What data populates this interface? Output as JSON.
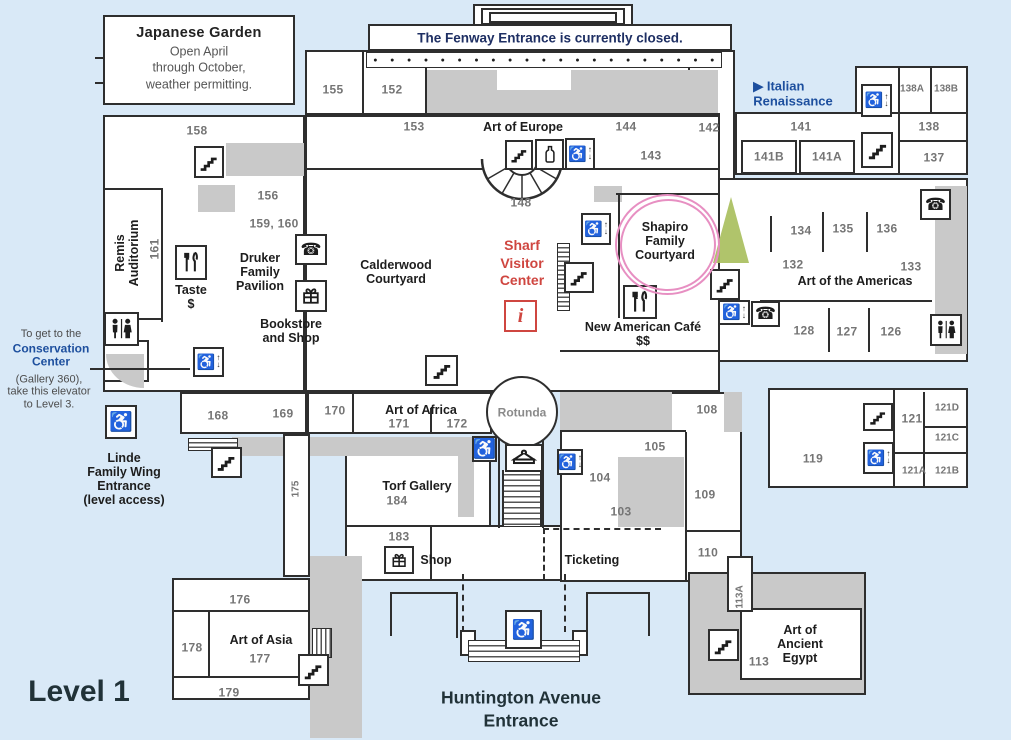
{
  "title": "Museum floor plan — Level 1",
  "level_label": "Level 1",
  "banner": {
    "text": "The Fenway Entrance is currently closed."
  },
  "entrances": {
    "huntington": "Huntington Avenue\nEntrance",
    "linde": "Linde\nFamily Wing\nEntrance\n(level access)",
    "fenway_closed": "The Fenway Entrance is currently closed."
  },
  "colors": {
    "background": "#d9e9f7",
    "wall": "#2e2e2e",
    "room_fill": "#ffffff",
    "service_fill": "#c9c9c9",
    "number_text": "#757575",
    "label_text": "#1d1d1d",
    "accent_red": "#cf4640",
    "accent_blue": "#1d4f9e",
    "banner_text": "#1e2f63",
    "highlight_pink": "#e78fc2",
    "marker_green": "#a9bf5e"
  },
  "labels": [
    {
      "t": "Japanese Garden",
      "x": 199,
      "y": 33,
      "c": "jgt",
      "n": "japanese-garden-title"
    },
    {
      "t": "Open April\nthrough October,\nweather permitting.",
      "x": 199,
      "y": 68,
      "c": "jgb",
      "n": "japanese-garden-note"
    },
    {
      "t": "The Fenway Entrance is currently closed.",
      "x": 550,
      "y": 38,
      "c": "banner-t",
      "n": "fenway-banner-text"
    },
    {
      "t": "155",
      "x": 333,
      "y": 90,
      "c": "num"
    },
    {
      "t": "152",
      "x": 392,
      "y": 90,
      "c": "num"
    },
    {
      "t": "158",
      "x": 197,
      "y": 131,
      "c": "num"
    },
    {
      "t": "153",
      "x": 414,
      "y": 127,
      "c": "num"
    },
    {
      "t": "Art of Europe",
      "x": 523,
      "y": 127,
      "c": "sec",
      "n": "art-of-europe-label"
    },
    {
      "t": "144",
      "x": 626,
      "y": 127,
      "c": "num"
    },
    {
      "t": "142",
      "x": 709,
      "y": 128,
      "c": "num"
    },
    {
      "t": "143",
      "x": 651,
      "y": 156,
      "c": "num"
    },
    {
      "t": "148",
      "x": 521,
      "y": 203,
      "c": "num"
    },
    {
      "t": "▶ Italian\nRenaissance",
      "x": 793,
      "y": 94,
      "c": "blue-t",
      "n": "italian-renaissance-label"
    },
    {
      "t": "141",
      "x": 801,
      "y": 127,
      "c": "num"
    },
    {
      "t": "141B",
      "x": 769,
      "y": 157,
      "c": "num"
    },
    {
      "t": "141A",
      "x": 827,
      "y": 157,
      "c": "num"
    },
    {
      "t": "138A",
      "x": 912,
      "y": 89,
      "c": "numS"
    },
    {
      "t": "138B",
      "x": 946,
      "y": 89,
      "c": "numS"
    },
    {
      "t": "138",
      "x": 929,
      "y": 127,
      "c": "num"
    },
    {
      "t": "137",
      "x": 934,
      "y": 158,
      "c": "num"
    },
    {
      "t": "156",
      "x": 268,
      "y": 196,
      "c": "num"
    },
    {
      "t": "159, 160",
      "x": 274,
      "y": 224,
      "c": "num"
    },
    {
      "t": "161",
      "x": 155,
      "y": 249,
      "c": "num vert"
    },
    {
      "t": "Remis\nAuditorium",
      "x": 127,
      "y": 253,
      "c": "sec vert",
      "n": "remis-auditorium-label"
    },
    {
      "t": "Druker\nFamily\nPavilion",
      "x": 260,
      "y": 272,
      "c": "sec",
      "n": "druker-family-pavilion-label"
    },
    {
      "t": "Taste\n$",
      "x": 191,
      "y": 297,
      "c": "sec",
      "n": "taste-label"
    },
    {
      "t": "Bookstore\nand Shop",
      "x": 291,
      "y": 331,
      "c": "sec",
      "n": "bookstore-and-shop-label"
    },
    {
      "t": "Calderwood\nCourtyard",
      "x": 396,
      "y": 272,
      "c": "sec",
      "n": "calderwood-courtyard-label"
    },
    {
      "t": "Sharf\nVisitor\nCenter",
      "x": 522,
      "y": 263,
      "c": "red-t",
      "n": "sharf-visitor-center-label"
    },
    {
      "t": "Shapiro\nFamily\nCourtyard",
      "x": 665,
      "y": 241,
      "c": "sec",
      "n": "shapiro-family-courtyard-label"
    },
    {
      "t": "New American Café\n$$",
      "x": 643,
      "y": 334,
      "c": "sec",
      "n": "new-american-cafe-label"
    },
    {
      "t": "134",
      "x": 801,
      "y": 231,
      "c": "num"
    },
    {
      "t": "135",
      "x": 843,
      "y": 229,
      "c": "num"
    },
    {
      "t": "136",
      "x": 887,
      "y": 229,
      "c": "num"
    },
    {
      "t": "132",
      "x": 793,
      "y": 265,
      "c": "num"
    },
    {
      "t": "133",
      "x": 911,
      "y": 267,
      "c": "num"
    },
    {
      "t": "Art of the Americas",
      "x": 855,
      "y": 281,
      "c": "sec",
      "n": "art-of-the-americas-label"
    },
    {
      "t": "128",
      "x": 804,
      "y": 331,
      "c": "num"
    },
    {
      "t": "127",
      "x": 847,
      "y": 332,
      "c": "num"
    },
    {
      "t": "126",
      "x": 891,
      "y": 332,
      "c": "num"
    },
    {
      "t": "To get to the",
      "x": 51,
      "y": 334,
      "c": "note",
      "n": "conservation-note-line1"
    },
    {
      "t": "Conservation\nCenter",
      "x": 51,
      "y": 356,
      "c": "noteB",
      "n": "conservation-center-label"
    },
    {
      "t": "(Gallery 360),\ntake this elevator\nto Level 3.",
      "x": 49,
      "y": 392,
      "c": "note",
      "n": "conservation-note-line2"
    },
    {
      "t": "Linde\nFamily Wing\nEntrance\n(level access)",
      "x": 124,
      "y": 479,
      "c": "sec",
      "n": "linde-family-wing-entrance-label"
    },
    {
      "t": "168",
      "x": 218,
      "y": 416,
      "c": "num"
    },
    {
      "t": "169",
      "x": 283,
      "y": 414,
      "c": "num"
    },
    {
      "t": "170",
      "x": 335,
      "y": 411,
      "c": "num"
    },
    {
      "t": "Art of Africa",
      "x": 421,
      "y": 410,
      "c": "sec",
      "n": "art-of-africa-label"
    },
    {
      "t": "171",
      "x": 399,
      "y": 424,
      "c": "num"
    },
    {
      "t": "172",
      "x": 457,
      "y": 424,
      "c": "num"
    },
    {
      "t": "Rotunda",
      "x": 522,
      "y": 413,
      "c": "gray-t",
      "n": "rotunda-label"
    },
    {
      "t": "175",
      "x": 296,
      "y": 489,
      "c": "numS vert"
    },
    {
      "t": "Torf Gallery",
      "x": 417,
      "y": 486,
      "c": "sec",
      "n": "torf-gallery-label"
    },
    {
      "t": "184",
      "x": 397,
      "y": 501,
      "c": "num"
    },
    {
      "t": "183",
      "x": 399,
      "y": 537,
      "c": "num"
    },
    {
      "t": "Shop",
      "x": 436,
      "y": 560,
      "c": "sec",
      "n": "shop-label"
    },
    {
      "t": "Ticketing",
      "x": 592,
      "y": 560,
      "c": "sec",
      "n": "ticketing-label"
    },
    {
      "t": "108",
      "x": 707,
      "y": 410,
      "c": "num"
    },
    {
      "t": "105",
      "x": 655,
      "y": 447,
      "c": "num"
    },
    {
      "t": "104",
      "x": 600,
      "y": 478,
      "c": "num"
    },
    {
      "t": "103",
      "x": 621,
      "y": 512,
      "c": "num"
    },
    {
      "t": "109",
      "x": 705,
      "y": 495,
      "c": "num"
    },
    {
      "t": "110",
      "x": 708,
      "y": 553,
      "c": "num"
    },
    {
      "t": "119",
      "x": 813,
      "y": 459,
      "c": "num"
    },
    {
      "t": "121",
      "x": 912,
      "y": 419,
      "c": "num"
    },
    {
      "t": "121D",
      "x": 947,
      "y": 408,
      "c": "numS"
    },
    {
      "t": "121C",
      "x": 947,
      "y": 438,
      "c": "numS"
    },
    {
      "t": "121A",
      "x": 914,
      "y": 471,
      "c": "numS"
    },
    {
      "t": "121B",
      "x": 947,
      "y": 471,
      "c": "numS"
    },
    {
      "t": "176",
      "x": 240,
      "y": 600,
      "c": "num"
    },
    {
      "t": "Art of Asia",
      "x": 261,
      "y": 640,
      "c": "sec",
      "n": "art-of-asia-label"
    },
    {
      "t": "177",
      "x": 260,
      "y": 659,
      "c": "num"
    },
    {
      "t": "178",
      "x": 192,
      "y": 648,
      "c": "num"
    },
    {
      "t": "179",
      "x": 229,
      "y": 693,
      "c": "num"
    },
    {
      "t": "113A",
      "x": 740,
      "y": 597,
      "c": "numS vert"
    },
    {
      "t": "Art of\nAncient\nEgypt",
      "x": 800,
      "y": 644,
      "c": "sec",
      "n": "art-of-ancient-egypt-label"
    },
    {
      "t": "113",
      "x": 759,
      "y": 662,
      "c": "num"
    },
    {
      "t": "Huntington Avenue\nEntrance",
      "x": 521,
      "y": 709,
      "c": "hunt",
      "n": "huntington-avenue-entrance-label"
    },
    {
      "t": "Level 1",
      "x": 79,
      "y": 692,
      "c": "lvl",
      "n": "level-1-label"
    }
  ],
  "icons": [
    {
      "type": "stairs",
      "x": 194,
      "y": 146,
      "w": 30,
      "h": 32
    },
    {
      "type": "stairs",
      "x": 505,
      "y": 140,
      "w": 28,
      "h": 30
    },
    {
      "type": "water-fountain",
      "x": 535,
      "y": 139,
      "w": 29,
      "h": 31
    },
    {
      "type": "elevator",
      "x": 565,
      "y": 138,
      "w": 30,
      "h": 32
    },
    {
      "type": "elevator",
      "x": 861,
      "y": 84,
      "w": 31,
      "h": 33
    },
    {
      "type": "stairs",
      "x": 861,
      "y": 132,
      "w": 32,
      "h": 36
    },
    {
      "type": "phone",
      "x": 920,
      "y": 189,
      "w": 31,
      "h": 31
    },
    {
      "type": "restroom",
      "x": 930,
      "y": 314,
      "w": 32,
      "h": 32
    },
    {
      "type": "stairs",
      "x": 710,
      "y": 269,
      "w": 30,
      "h": 31
    },
    {
      "type": "elevator",
      "x": 718,
      "y": 300,
      "w": 32,
      "h": 25
    },
    {
      "type": "phone",
      "x": 751,
      "y": 301,
      "w": 29,
      "h": 26
    },
    {
      "type": "elevator",
      "x": 581,
      "y": 213,
      "w": 30,
      "h": 32
    },
    {
      "type": "stairs",
      "x": 564,
      "y": 262,
      "w": 30,
      "h": 31
    },
    {
      "type": "restaurant",
      "x": 623,
      "y": 285,
      "w": 34,
      "h": 34
    },
    {
      "type": "info",
      "x": 504,
      "y": 300,
      "w": 33,
      "h": 32
    },
    {
      "type": "phone",
      "x": 295,
      "y": 234,
      "w": 32,
      "h": 31
    },
    {
      "type": "shop",
      "x": 295,
      "y": 280,
      "w": 32,
      "h": 32
    },
    {
      "type": "restaurant",
      "x": 175,
      "y": 245,
      "w": 32,
      "h": 35
    },
    {
      "type": "restroom",
      "x": 104,
      "y": 312,
      "w": 35,
      "h": 34
    },
    {
      "type": "elevator",
      "x": 193,
      "y": 347,
      "w": 31,
      "h": 30
    },
    {
      "type": "wheelchair",
      "x": 105,
      "y": 405,
      "w": 32,
      "h": 34
    },
    {
      "type": "stairs",
      "x": 211,
      "y": 447,
      "w": 31,
      "h": 31
    },
    {
      "type": "stairs",
      "x": 425,
      "y": 355,
      "w": 33,
      "h": 31
    },
    {
      "type": "wheelchair",
      "x": 472,
      "y": 436,
      "w": 25,
      "h": 26
    },
    {
      "type": "coat-check",
      "x": 505,
      "y": 444,
      "w": 38,
      "h": 28
    },
    {
      "type": "elevator",
      "x": 557,
      "y": 449,
      "w": 26,
      "h": 26
    },
    {
      "type": "stairs",
      "x": 863,
      "y": 403,
      "w": 30,
      "h": 28
    },
    {
      "type": "elevator",
      "x": 863,
      "y": 442,
      "w": 31,
      "h": 32
    },
    {
      "type": "wheelchair",
      "x": 505,
      "y": 610,
      "w": 37,
      "h": 39
    },
    {
      "type": "shop",
      "x": 384,
      "y": 546,
      "w": 30,
      "h": 28
    },
    {
      "type": "stairs",
      "x": 708,
      "y": 629,
      "w": 31,
      "h": 32
    },
    {
      "type": "stairs",
      "x": 298,
      "y": 654,
      "w": 31,
      "h": 32
    }
  ],
  "highlights": {
    "shapiro_circle": "pink hand-drawn circle around Shapiro Family Courtyard",
    "green_marker": "green triangle marker beside Shapiro Family Courtyard"
  }
}
